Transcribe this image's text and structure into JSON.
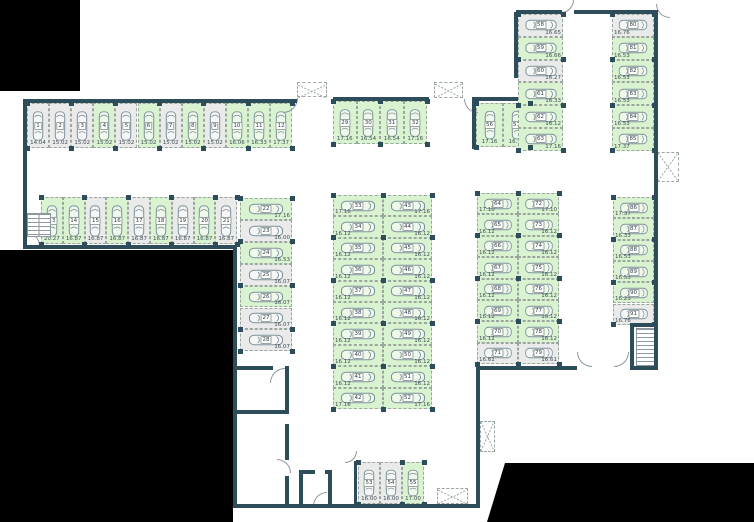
{
  "plan": {
    "type": "parking-garage-floor-plan",
    "stall_total": 91,
    "status_legend": {
      "free_color": "#d9f2cf",
      "occupied_color": "#eaeaea"
    },
    "sections": [
      {
        "id": "row-northwest-1-12",
        "dir": "row",
        "orient": "v",
        "labelPos": "b",
        "x": 27,
        "y": 103,
        "sw": 22.1,
        "sh": 45,
        "stalls": [
          {
            "n": "1",
            "a": "14.04",
            "s": "taken"
          },
          {
            "n": "2",
            "a": "15.02",
            "s": "taken"
          },
          {
            "n": "3",
            "a": "15.02",
            "s": "taken"
          },
          {
            "n": "4",
            "a": "15.02",
            "s": "free"
          },
          {
            "n": "5",
            "a": "15.02",
            "s": "taken"
          },
          {
            "n": "6",
            "a": "15.02",
            "s": "free"
          },
          {
            "n": "7",
            "a": "15.02",
            "s": "taken"
          },
          {
            "n": "8",
            "a": "15.02",
            "s": "free"
          },
          {
            "n": "9",
            "a": "15.02",
            "s": "taken"
          },
          {
            "n": "10",
            "a": "16.06",
            "s": "free"
          },
          {
            "n": "11",
            "a": "16.33",
            "s": "free"
          },
          {
            "n": "12",
            "a": "17.37",
            "s": "free"
          }
        ]
      },
      {
        "id": "row-west-13-21",
        "dir": "row",
        "orient": "v",
        "labelPos": "b",
        "x": 41,
        "y": 197,
        "sw": 21.8,
        "sh": 47,
        "stalls": [
          {
            "n": "13",
            "a": "20.27",
            "s": "free"
          },
          {
            "n": "14",
            "a": "16.87",
            "s": "free"
          },
          {
            "n": "15",
            "a": "16.87",
            "s": "taken"
          },
          {
            "n": "16",
            "a": "16.87",
            "s": "free"
          },
          {
            "n": "17",
            "a": "16.87",
            "s": "taken"
          },
          {
            "n": "18",
            "a": "16.87",
            "s": "free"
          },
          {
            "n": "19",
            "a": "16.87",
            "s": "taken"
          },
          {
            "n": "20",
            "a": "16.87",
            "s": "free"
          },
          {
            "n": "21",
            "a": "16.87",
            "s": "taken"
          }
        ]
      },
      {
        "id": "col-west-22-28",
        "dir": "col",
        "orient": "h",
        "labelPos": "br",
        "x": 240,
        "y": 198,
        "sw": 52,
        "sh": 21.9,
        "stalls": [
          {
            "n": "22",
            "a": "17.16",
            "s": "free"
          },
          {
            "n": "23",
            "a": "16.00",
            "s": "taken"
          },
          {
            "n": "24",
            "a": "16.53",
            "s": "free"
          },
          {
            "n": "25",
            "a": "16.07",
            "s": "taken"
          },
          {
            "n": "26",
            "a": "16.07",
            "s": "free"
          },
          {
            "n": "27",
            "a": "16.07",
            "s": "taken"
          },
          {
            "n": "28",
            "a": "16.07",
            "s": "taken"
          }
        ]
      },
      {
        "id": "row-north-middle-29-32",
        "dir": "row",
        "orient": "v",
        "labelPos": "b",
        "x": 333,
        "y": 101,
        "sw": 23.5,
        "sh": 43,
        "stalls": [
          {
            "n": "29",
            "a": "17.16",
            "s": "free"
          },
          {
            "n": "30",
            "a": "16.54",
            "s": "free"
          },
          {
            "n": "31",
            "a": "16.54",
            "s": "free"
          },
          {
            "n": "32",
            "a": "17.16",
            "s": "free"
          }
        ]
      },
      {
        "id": "col-center-left-33-42",
        "dir": "col",
        "orient": "h",
        "labelPos": "bl",
        "x": 333,
        "y": 195,
        "sw": 50,
        "sh": 21.4,
        "stalls": [
          {
            "n": "33",
            "a": "17.16",
            "s": "free"
          },
          {
            "n": "34",
            "a": "16.12",
            "s": "free"
          },
          {
            "n": "35",
            "a": "16.12",
            "s": "free"
          },
          {
            "n": "36",
            "a": "16.12",
            "s": "free"
          },
          {
            "n": "37",
            "a": "16.12",
            "s": "free"
          },
          {
            "n": "38",
            "a": "16.12",
            "s": "free"
          },
          {
            "n": "39",
            "a": "16.12",
            "s": "free"
          },
          {
            "n": "40",
            "a": "16.12",
            "s": "free"
          },
          {
            "n": "41",
            "a": "16.12",
            "s": "free"
          },
          {
            "n": "42",
            "a": "17.16",
            "s": "free"
          }
        ]
      },
      {
        "id": "col-center-right-43-52",
        "dir": "col",
        "orient": "h",
        "labelPos": "br",
        "x": 383,
        "y": 195,
        "sw": 49,
        "sh": 21.4,
        "stalls": [
          {
            "n": "43",
            "a": "17.16",
            "s": "free"
          },
          {
            "n": "44",
            "a": "16.12",
            "s": "free"
          },
          {
            "n": "45",
            "a": "16.12",
            "s": "free"
          },
          {
            "n": "46",
            "a": "16.12",
            "s": "free"
          },
          {
            "n": "47",
            "a": "16.12",
            "s": "free"
          },
          {
            "n": "48",
            "a": "16.12",
            "s": "free"
          },
          {
            "n": "49",
            "a": "16.12",
            "s": "free"
          },
          {
            "n": "50",
            "a": "16.12",
            "s": "free"
          },
          {
            "n": "51",
            "a": "16.12",
            "s": "free"
          },
          {
            "n": "52",
            "a": "17.16",
            "s": "free"
          }
        ]
      },
      {
        "id": "row-south-53-55",
        "dir": "row",
        "orient": "v",
        "labelPos": "b",
        "x": 358,
        "y": 462,
        "sw": 22,
        "sh": 42,
        "stalls": [
          {
            "n": "53",
            "a": "16.00",
            "s": "taken"
          },
          {
            "n": "54",
            "a": "16.00",
            "s": "taken"
          },
          {
            "n": "55",
            "a": "17.00",
            "s": "free"
          }
        ]
      },
      {
        "id": "row-east-56-57",
        "dir": "row",
        "orient": "v",
        "labelPos": "b",
        "x": 476,
        "y": 103,
        "sw": 27,
        "sh": 44,
        "stalls": [
          {
            "n": "56",
            "a": "17.16",
            "s": "free"
          },
          {
            "n": "57",
            "a": "16.54",
            "s": "free"
          }
        ]
      },
      {
        "id": "col-northeast-58-63",
        "dir": "col",
        "orient": "h",
        "labelPos": "br",
        "x": 518,
        "y": 14,
        "sw": 45,
        "sh": 22.8,
        "stalls": [
          {
            "n": "58",
            "a": "16.65",
            "s": "taken"
          },
          {
            "n": "59",
            "a": "16.66",
            "s": "free"
          },
          {
            "n": "60",
            "a": "16.27",
            "s": "taken"
          },
          {
            "n": "61",
            "a": "16.33",
            "s": "free"
          },
          {
            "n": "62",
            "a": "16.12",
            "s": "free"
          },
          {
            "n": "63",
            "a": "17.16",
            "s": "free"
          }
        ]
      },
      {
        "id": "col-east-left-64-71",
        "dir": "col",
        "orient": "h",
        "labelPos": "bl",
        "x": 477,
        "y": 193,
        "sw": 41,
        "sh": 21.4,
        "stalls": [
          {
            "n": "64",
            "a": "17.10",
            "s": "free"
          },
          {
            "n": "65",
            "a": "16.12",
            "s": "free"
          },
          {
            "n": "66",
            "a": "16.12",
            "s": "free"
          },
          {
            "n": "67",
            "a": "16.12",
            "s": "free"
          },
          {
            "n": "68",
            "a": "16.12",
            "s": "free"
          },
          {
            "n": "69",
            "a": "16.12",
            "s": "free"
          },
          {
            "n": "70",
            "a": "16.12",
            "s": "free"
          },
          {
            "n": "71",
            "a": "16.61",
            "s": "taken"
          }
        ]
      },
      {
        "id": "col-east-right-72-79",
        "dir": "col",
        "orient": "h",
        "labelPos": "br",
        "x": 518,
        "y": 193,
        "sw": 41,
        "sh": 21.4,
        "stalls": [
          {
            "n": "72",
            "a": "17.10",
            "s": "free"
          },
          {
            "n": "73",
            "a": "16.12",
            "s": "free"
          },
          {
            "n": "74",
            "a": "16.12",
            "s": "free"
          },
          {
            "n": "75",
            "a": "16.12",
            "s": "free"
          },
          {
            "n": "76",
            "a": "16.12",
            "s": "free"
          },
          {
            "n": "77",
            "a": "16.12",
            "s": "free"
          },
          {
            "n": "78",
            "a": "16.12",
            "s": "free"
          },
          {
            "n": "79",
            "a": "16.61",
            "s": "taken"
          }
        ]
      },
      {
        "id": "col-fareast-top-80-85",
        "dir": "col",
        "orient": "h",
        "labelPos": "bl",
        "x": 612,
        "y": 14,
        "sw": 42,
        "sh": 22.8,
        "stalls": [
          {
            "n": "80",
            "a": "16.76",
            "s": "taken"
          },
          {
            "n": "81",
            "a": "16.53",
            "s": "free"
          },
          {
            "n": "82",
            "a": "16.53",
            "s": "free"
          },
          {
            "n": "83",
            "a": "16.53",
            "s": "free"
          },
          {
            "n": "84",
            "a": "16.53",
            "s": "free"
          },
          {
            "n": "85",
            "a": "17.37",
            "s": "free"
          }
        ]
      },
      {
        "id": "col-fareast-bottom-86-91",
        "dir": "col",
        "orient": "h",
        "labelPos": "bl",
        "x": 613,
        "y": 197,
        "sw": 41,
        "sh": 21.3,
        "stalls": [
          {
            "n": "86",
            "a": "17.37",
            "s": "free"
          },
          {
            "n": "87",
            "a": "16.33",
            "s": "free"
          },
          {
            "n": "88",
            "a": "16.53",
            "s": "free"
          },
          {
            "n": "89",
            "a": "16.53",
            "s": "free"
          },
          {
            "n": "90",
            "a": "16.23",
            "s": "free"
          },
          {
            "n": "91",
            "a": "16.76",
            "s": "taken"
          }
        ]
      }
    ]
  },
  "structure": {
    "colors": {
      "wall": "#2e4d5b",
      "outside": "#000000",
      "stall_border": "#9ba69e",
      "car_outline": "#7e929c",
      "text": "#3f4e55"
    },
    "walls": [
      [
        23,
        99,
        274,
        4
      ],
      [
        23,
        99,
        4,
        150
      ],
      [
        23,
        245,
        214,
        4
      ],
      [
        233,
        245,
        4,
        263
      ],
      [
        233,
        504,
        247,
        4
      ],
      [
        476,
        366,
        4,
        142
      ],
      [
        476,
        366,
        101,
        4
      ],
      [
        630,
        366,
        28,
        4
      ],
      [
        654,
        12,
        4,
        358
      ],
      [
        516,
        10,
        46,
        4
      ],
      [
        574,
        10,
        84,
        4
      ],
      [
        514,
        12,
        4,
        66
      ],
      [
        472,
        97,
        46,
        4
      ],
      [
        472,
        97,
        4,
        52
      ],
      [
        333,
        97,
        96,
        4
      ],
      [
        233,
        366,
        40,
        4
      ],
      [
        285,
        366,
        4,
        48
      ],
      [
        233,
        410,
        56,
        4
      ],
      [
        285,
        424,
        4,
        36
      ],
      [
        285,
        476,
        4,
        32
      ],
      [
        299,
        470,
        16,
        4
      ],
      [
        325,
        470,
        7,
        4
      ],
      [
        299,
        470,
        4,
        38
      ],
      [
        328,
        470,
        4,
        38
      ],
      [
        354,
        461,
        3,
        43
      ],
      [
        630,
        323,
        28,
        4
      ],
      [
        630,
        323,
        4,
        47
      ]
    ],
    "black_rects": [
      [
        0,
        0,
        80,
        91
      ],
      [
        0,
        250,
        233,
        272
      ]
    ],
    "black_polygon": {
      "top": 462,
      "height": 60,
      "points": [
        [
          487,
          60
        ],
        [
          505,
          1
        ],
        [
          754,
          1
        ],
        [
          754,
          60
        ]
      ]
    },
    "xboxes": [
      [
        297,
        82,
        30,
        15
      ],
      [
        434,
        82,
        29,
        16
      ],
      [
        657,
        152,
        22,
        30
      ],
      [
        480,
        421,
        15,
        31
      ],
      [
        437,
        488,
        31,
        16
      ]
    ],
    "doors": [
      [
        283,
        98,
        15,
        "br"
      ],
      [
        464,
        99,
        14,
        "bl"
      ],
      [
        561,
        0,
        13,
        "br"
      ],
      [
        656,
        4,
        14,
        "bl"
      ],
      [
        26,
        232,
        14,
        "tr"
      ],
      [
        270,
        368,
        15,
        "tl"
      ],
      [
        277,
        459,
        14,
        "tr"
      ],
      [
        313,
        492,
        14,
        "tl"
      ],
      [
        345,
        451,
        12,
        "br"
      ],
      [
        577,
        352,
        15,
        "bl"
      ],
      [
        614,
        352,
        15,
        "br"
      ]
    ],
    "stairs": [
      {
        "x": 27,
        "y": 213,
        "w": 22,
        "h": 22,
        "flights": 2
      },
      {
        "x": 636,
        "y": 328,
        "w": 20,
        "h": 36,
        "flights": 1
      }
    ]
  }
}
